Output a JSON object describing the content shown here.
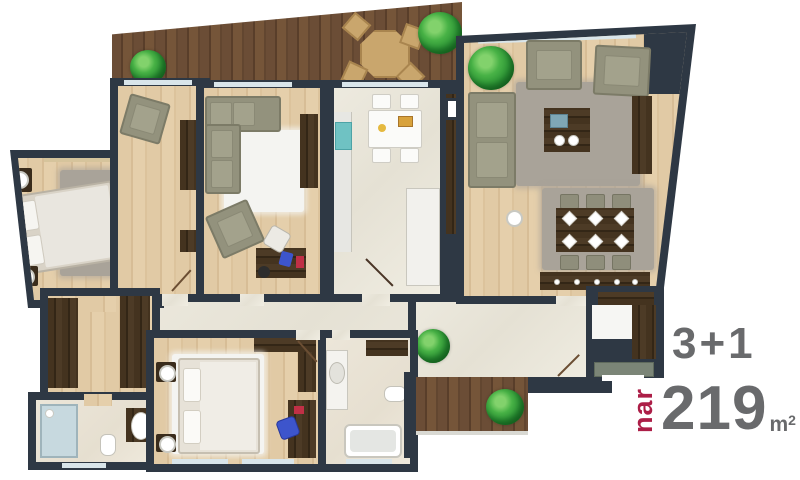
{
  "annotation": {
    "rooms_label": "3+1",
    "brand": "nar",
    "area_value": "219",
    "area_unit": "m",
    "area_unit_sup": "2"
  },
  "colors": {
    "wall": "#2e3844",
    "accent_brand": "#ac1e47",
    "text_gray": "#696a6c",
    "terrace_wood": "#6b4d36",
    "interior_wood_floor": "#ddc5a0",
    "dark_furniture_wood": "#44331f",
    "marble_floor": "#eae7dc",
    "rug_gray": "#a9a399",
    "rug_white": "#f4f4f1",
    "sofa_gray_green": "#93927d",
    "sink_teal": "#6fc2c3",
    "plant_green": "#2f9737",
    "window_glass": "#d9e5ea"
  }
}
